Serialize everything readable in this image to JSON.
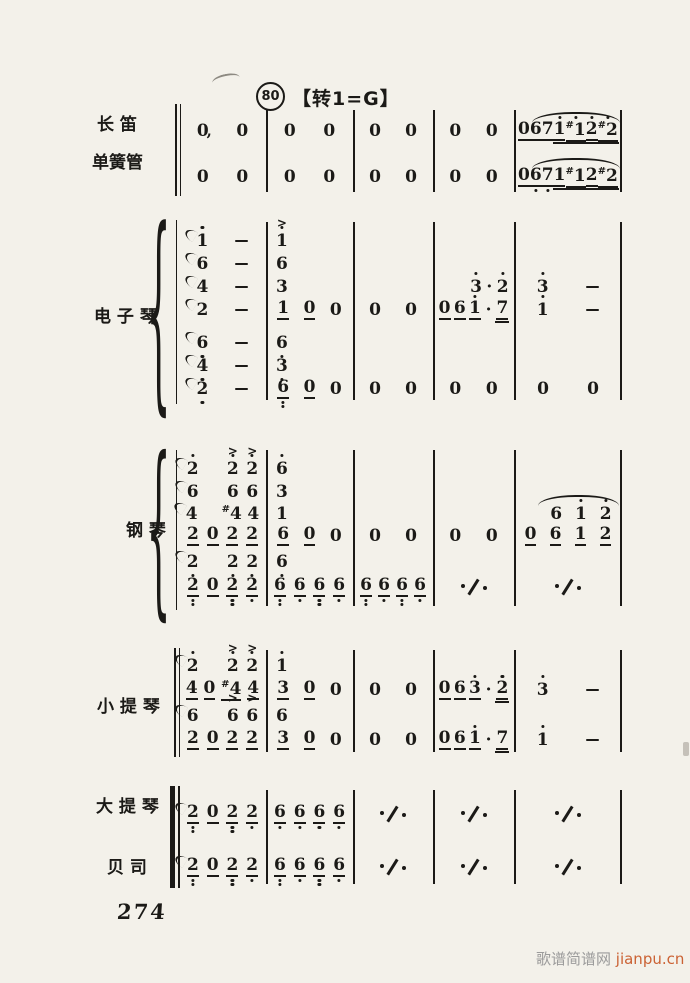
{
  "page": {
    "bg": "#f3f1ea",
    "ink": "#1b1a17"
  },
  "header": {
    "rehearsal": "80",
    "key_change": "【转1=G】"
  },
  "footer": {
    "page_number": "274",
    "watermark_site": "歌谱简谱网 ",
    "watermark_domain": "jianpu.cn",
    "watermark_site_color": "#9b9b9b",
    "watermark_domain_color": "#cb6234"
  },
  "score": {
    "x0": 179,
    "measure_widths": [
      87,
      87,
      80,
      81,
      108
    ],
    "barline_x": [
      266,
      353,
      433,
      514
    ],
    "final_x": 620,
    "groups": [
      {
        "id": "winds",
        "labels": [
          {
            "text": "长 笛",
            "x": 97,
            "y": 110
          },
          {
            "text": "单簧管",
            "x": 92,
            "y": 148
          }
        ],
        "bracket": {
          "lines": [
            {
              "x": 175,
              "w": 2.4,
              "y1": 104,
              "y2": 196
            },
            {
              "x": 180,
              "w": 1,
              "y1": 104,
              "y2": 196
            }
          ]
        },
        "bar_y": [
          110,
          192
        ],
        "rows": [
          {
            "y": 120,
            "cells": [
              [
                "0,",
                "0"
              ],
              [
                "0",
                "0"
              ],
              [
                "0",
                "0"
              ],
              [
                "0",
                "0"
              ],
              {
                "slur": [
                  17,
                  2
                ],
                "tokens": [
                  "0_",
                  "6_",
                  "7_",
                  "1'__",
                  "#1'__",
                  "2'__",
                  "#2'__"
                ]
              }
            ]
          },
          {
            "y": 166,
            "cells": [
              [
                "0",
                "0"
              ],
              [
                "0",
                "0"
              ],
              [
                "0",
                "0"
              ],
              [
                "0",
                "0"
              ],
              {
                "slur": [
                  17,
                  2
                ],
                "tokens": [
                  "0_",
                  "6!_",
                  "7!_",
                  "1__",
                  "#1__",
                  "2__",
                  "#2__"
                ]
              }
            ]
          }
        ]
      },
      {
        "id": "keyboard",
        "labels": [
          {
            "text": "电 子 琴",
            "x": 94,
            "y": 302
          }
        ],
        "bracket": {
          "braces": [
            {
              "x": 146,
              "y1": 216,
              "y2": 410
            }
          ],
          "lines": [
            {
              "x": 176,
              "w": 1.4,
              "y1": 220,
              "y2": 404
            }
          ]
        },
        "bar_y": [
          222,
          400
        ],
        "rows": [
          {
            "y": 230,
            "cells": [
              [
                "~1'",
                "-"
              ],
              {
                "align": "left",
                "tokens": [
                  ">1'"
                ]
              },
              [],
              [],
              []
            ]
          },
          {
            "y": 253,
            "cells": [
              [
                "~6",
                "-"
              ],
              {
                "align": "left",
                "tokens": [
                  "6"
                ]
              },
              [],
              [],
              []
            ]
          },
          {
            "y": 276,
            "cells": [
              [
                "~4",
                "-"
              ],
              {
                "align": "left",
                "tokens": [
                  "3"
                ]
              },
              [],
              [
                "",
                "",
                "3'",
                "·",
                "2'"
              ],
              [
                "3'",
                "-"
              ]
            ]
          },
          {
            "y": 299,
            "cells": [
              [
                "~2",
                "-"
              ],
              [
                "1_",
                "0_",
                "0"
              ],
              [
                "0",
                "0"
              ],
              [
                "0_",
                "6_",
                "1'_",
                "·",
                "7__"
              ],
              [
                "1'",
                "-"
              ]
            ]
          },
          {
            "y": 332,
            "cells": [
              [
                "~6!",
                "-"
              ],
              {
                "align": "left",
                "tokens": [
                  "6!"
                ]
              },
              [],
              [],
              []
            ]
          },
          {
            "y": 355,
            "cells": [
              [
                "~4!",
                "-"
              ],
              {
                "align": "left",
                "tokens": [
                  "3!"
                ]
              },
              [],
              [],
              []
            ]
          },
          {
            "y": 378,
            "cells": [
              [
                "~2!",
                "-"
              ],
              [
                "6!!_",
                "0_",
                "0"
              ],
              [
                "0",
                "0"
              ],
              [
                "0",
                "0"
              ],
              [
                "0",
                "0"
              ]
            ]
          }
        ]
      },
      {
        "id": "piano",
        "labels": [
          {
            "text": "钢 琴",
            "x": 126,
            "y": 516
          }
        ],
        "bracket": {
          "braces": [
            {
              "x": 146,
              "y1": 446,
              "y2": 616
            }
          ],
          "lines": [
            {
              "x": 176,
              "w": 1.4,
              "y1": 450,
              "y2": 610
            }
          ]
        },
        "bar_y": [
          450,
          606
        ],
        "rows": [
          {
            "y": 458,
            "cells": [
              [
                "~2'",
                "",
                ">2'",
                ">2'"
              ],
              {
                "align": "left",
                "tokens": [
                  "6'"
                ]
              },
              [],
              [],
              []
            ]
          },
          {
            "y": 481,
            "cells": [
              [
                "~6",
                "",
                "6",
                "6"
              ],
              {
                "align": "left",
                "tokens": [
                  "3"
                ]
              },
              [],
              [],
              []
            ]
          },
          {
            "y": 503,
            "cells": [
              [
                "~4",
                "",
                "#4",
                "4"
              ],
              {
                "align": "left",
                "tokens": [
                  "1"
                ]
              },
              [],
              [],
              {
                "slur": [
                  22,
                  3
                ],
                "tokens": [
                  "",
                  "6",
                  "1'",
                  "2'"
                ]
              }
            ]
          },
          {
            "y": 525,
            "cells": [
              [
                "2_",
                "0_",
                "2_",
                "2_"
              ],
              [
                "6_",
                "0_",
                "0"
              ],
              [
                "0",
                "0"
              ],
              [
                "0",
                "0"
              ],
              [
                "0_",
                "6_",
                "1_",
                "2_"
              ]
            ]
          },
          {
            "y": 551,
            "cells": [
              [
                "~2!",
                "",
                "2!",
                "2!"
              ],
              {
                "align": "left",
                "tokens": [
                  "6!"
                ]
              },
              [],
              [],
              []
            ]
          },
          {
            "y": 576,
            "cells": [
              [
                "2!!_",
                "0_",
                "2!!_",
                "2!_"
              ],
              [
                "6!!_",
                "6!_",
                "6!!_",
                "6!_"
              ],
              [
                "6!!_",
                "6!_",
                "6!!_",
                "6!_"
              ],
              [
                "%"
              ],
              [
                "%"
              ]
            ]
          }
        ]
      },
      {
        "id": "violin",
        "labels": [
          {
            "text": "小 提 琴",
            "x": 97,
            "y": 692
          }
        ],
        "bracket": {
          "lines": [
            {
              "x": 174,
              "w": 2.4,
              "y1": 648,
              "y2": 757
            },
            {
              "x": 179,
              "w": 1,
              "y1": 648,
              "y2": 757
            }
          ]
        },
        "bar_y": [
          650,
          752
        ],
        "rows": [
          {
            "y": 655,
            "cells": [
              [
                "~2'",
                "",
                ">2'",
                ">2'"
              ],
              {
                "align": "left",
                "tokens": [
                  "1'"
                ]
              },
              [],
              [],
              []
            ]
          },
          {
            "y": 679,
            "cells": [
              [
                "4_",
                "0_",
                "#4_",
                "4_"
              ],
              [
                "3_",
                "0_",
                "0"
              ],
              [
                "0",
                "0"
              ],
              [
                "0_",
                "6_",
                "3'_",
                "·",
                "2'__"
              ],
              [
                "3'",
                "-"
              ]
            ]
          },
          {
            "y": 705,
            "cells": [
              [
                "~6",
                "",
                ">6",
                ">6"
              ],
              {
                "align": "left",
                "tokens": [
                  "6"
                ]
              },
              [],
              [],
              []
            ]
          },
          {
            "y": 729,
            "cells": [
              [
                "2_",
                "0_",
                "2_",
                "2_"
              ],
              [
                "3_",
                "0_",
                "0"
              ],
              [
                "0",
                "0"
              ],
              [
                "0_",
                "6_",
                "1'_",
                "·",
                "7__"
              ],
              [
                "1'",
                "-"
              ]
            ]
          }
        ]
      },
      {
        "id": "cello-bass",
        "labels": [
          {
            "text": "大 提 琴",
            "x": 96,
            "y": 792
          },
          {
            "text": "贝 司",
            "x": 107,
            "y": 853
          }
        ],
        "bracket": {
          "lines": [
            {
              "x": 170,
              "w": 4.6,
              "y1": 786,
              "y2": 888
            },
            {
              "x": 178,
              "w": 1.8,
              "y1": 786,
              "y2": 888
            }
          ]
        },
        "bar_y": [
          790,
          884
        ],
        "rows": [
          {
            "y": 803,
            "cells": [
              [
                "~2!!_",
                "0_",
                "2!!_",
                "2!_"
              ],
              [
                "6!_",
                "6!_",
                "6!_",
                "6!_"
              ],
              [
                "%"
              ],
              [
                "%"
              ],
              [
                "%"
              ]
            ]
          },
          {
            "y": 856,
            "cells": [
              [
                "~2!!_",
                "0_",
                "2!!_",
                "2!_"
              ],
              [
                "6!!_",
                "6!_",
                "6!!_",
                "6!_"
              ],
              [
                "%"
              ],
              [
                "%"
              ],
              [
                "%"
              ]
            ]
          }
        ]
      }
    ]
  }
}
